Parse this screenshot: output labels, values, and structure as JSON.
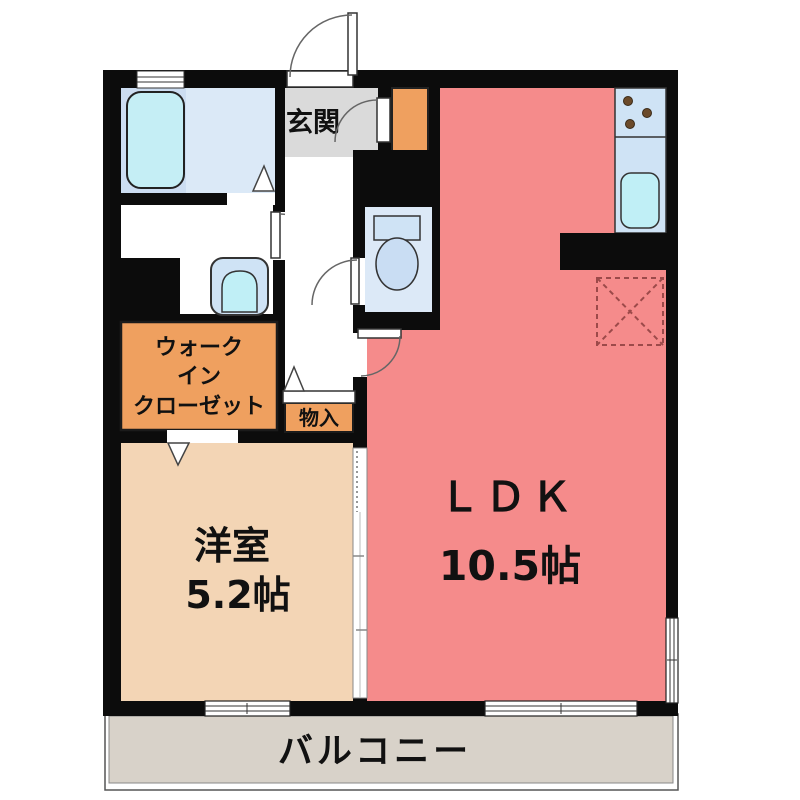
{
  "plan": {
    "rooms": {
      "genkan": {
        "label": "玄関"
      },
      "walk_in_closet": {
        "lines": [
          "ウォーク",
          "イン",
          "クローゼット"
        ]
      },
      "storage": {
        "label": "物入"
      },
      "bedroom": {
        "label": "洋室",
        "size": "5.2帖"
      },
      "ldk": {
        "label": "ＬＤＫ",
        "size": "10.5帖"
      },
      "balcony": {
        "label": "バルコニー"
      }
    },
    "fixtures": {
      "bathtub": "bathtub",
      "washbasin": "washbasin",
      "toilet": "toilet",
      "kitchen_sink": "kitchen-sink",
      "stove": "stove-burners",
      "refrigerator_space": "refrigerator-space"
    },
    "colors": {
      "wall": "#0c0c0c",
      "ldk": "#f58b8b",
      "bedroom": "#f3d5b5",
      "closet": "#efa05f",
      "genkan": "#dadada",
      "balcony": "#d8d2c9",
      "bath_left": "#ccddf1",
      "bath_right": "#dbe9f7",
      "tub": "#c5eef5",
      "toilet_floor": "#dce9f7",
      "fixture_blue": "#cfe3f5",
      "sink_cyan": "#c0eff6",
      "fridge_dash": "#9c4a4a"
    }
  }
}
